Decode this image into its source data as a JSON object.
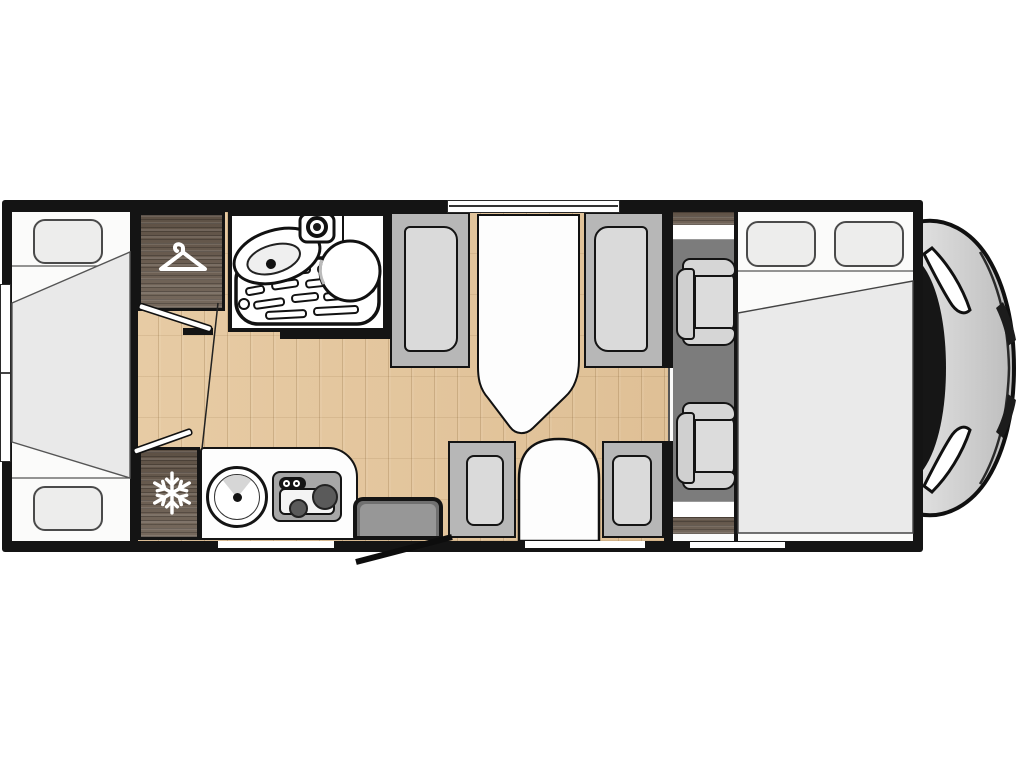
{
  "floorplan": {
    "title": "Motorhome floor plan (top view, cab front at right)",
    "rooms": {
      "rear_bed": {
        "label": "Rear bed",
        "pillow_count": 2
      },
      "rear_window": {
        "label": "Rear window"
      },
      "wardrobe": {
        "label": "Wardrobe",
        "icon": "hanger-icon"
      },
      "bathroom": {
        "label": "Washroom",
        "fixtures": [
          "washbasin",
          "shower tray",
          "shower head",
          "toilet"
        ]
      },
      "dinette": {
        "label": "Dinette",
        "table_label": "Table",
        "facing_bench_count": 2,
        "lower_seat_count": 3
      },
      "kitchen": {
        "label": "Kitchen",
        "fixtures": [
          "round sink",
          "two-burner hob"
        ]
      },
      "fridge": {
        "label": "Refrigerator",
        "icon": "snowflake-icon"
      },
      "entrance": {
        "label": "Entrance door",
        "state": "open"
      },
      "cab": {
        "label": "Driver cab",
        "seat_count": 2
      },
      "front_bed": {
        "label": "Front bed",
        "pillow_count": 2
      },
      "vehicle_front": {
        "label": "Vehicle nose"
      }
    },
    "colors": {
      "wall": "#141414",
      "interior": "#fbfbfa",
      "wood_floor": "#e3c79f",
      "furniture_wood": "#6d6054",
      "bench": "#b7b7b7",
      "cushion": "#dadada",
      "cab_floor": "#7c7c7c",
      "duvet": "#e9e9e9",
      "step": "#707070",
      "hood": "#d2d2d2"
    }
  }
}
